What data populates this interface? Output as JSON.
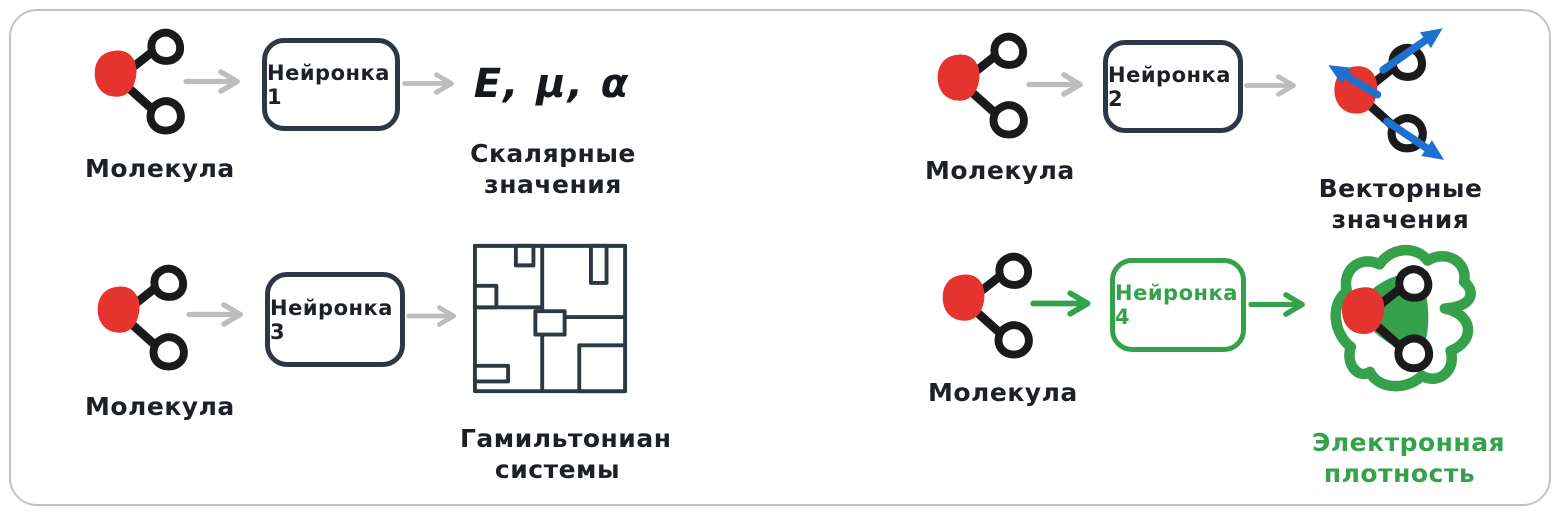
{
  "title_hint": "Neural networks predicting molecular properties",
  "colors": {
    "red": "#e5342e",
    "ink": "#1a1a1a",
    "box_border": "#2d3844",
    "gray_arrow": "#bdbdbd",
    "green": "#35a24b",
    "blue": "#1e70d1",
    "frame_border": "#c3c3c3"
  },
  "pipelines": [
    {
      "id": "scalar",
      "input_label": "Молекула",
      "box_label": "Нейронка 1",
      "output_formula": "E, μ, α",
      "output_label_line1": "Скалярные",
      "output_label_line2": "значения"
    },
    {
      "id": "vector",
      "input_label": "Молекула",
      "box_label": "Нейронка 2",
      "output_label_line1": "Векторные",
      "output_label_line2": "значения"
    },
    {
      "id": "hamiltonian",
      "input_label": "Молекула",
      "box_label": "Нейронка 3",
      "output_label_line1": "Гамильтониан",
      "output_label_line2": "системы"
    },
    {
      "id": "density",
      "input_label": "Молекула",
      "box_label": "Нейронка 4",
      "output_label_line1": "Электронная",
      "output_label_line2": "плотность"
    }
  ]
}
